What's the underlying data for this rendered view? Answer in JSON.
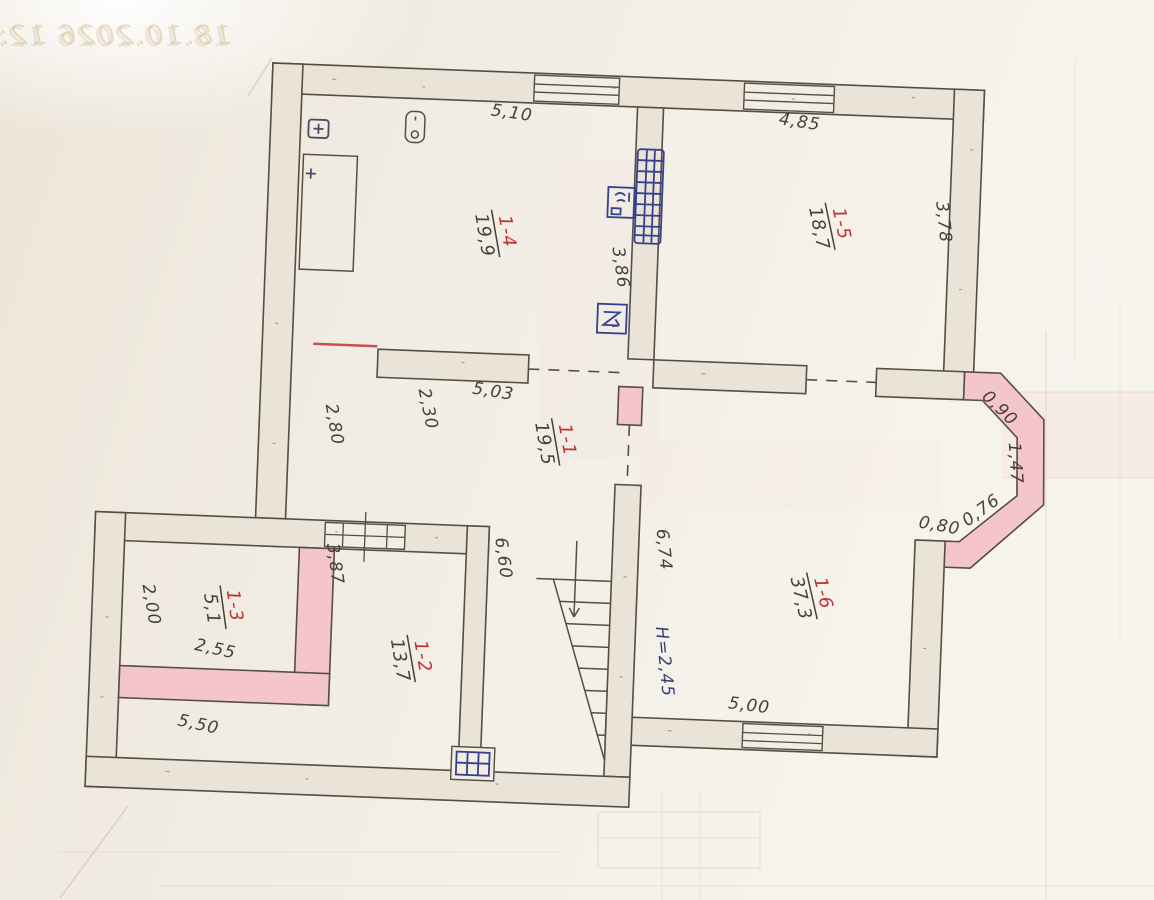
{
  "watermark": {
    "text": "18.10.2026 12:4"
  },
  "rooms": [
    {
      "num": "1-1",
      "area": "19,5"
    },
    {
      "num": "1-2",
      "area": "13,7"
    },
    {
      "num": "1-3",
      "area": "5,1"
    },
    {
      "num": "1-4",
      "area": "19,9"
    },
    {
      "num": "1-5",
      "area": "18,7"
    },
    {
      "num": "1-6",
      "area": "37,3"
    }
  ],
  "dimensions": {
    "r14_width": "5,10",
    "r15_width": "4,85",
    "mid_wall": "3,86",
    "r15_depth": "3,78",
    "hall_wall": "5,03",
    "hall_width": "2,30",
    "hall_left": "2,80",
    "bay_seg1": "0,90",
    "bay_seg2": "1,47",
    "bay_seg3": "0,76",
    "bay_seg4": "0,80",
    "stair_wall": "6,74",
    "stair_height": "H=2,45",
    "r16_window": "5,00",
    "r12_depth": "6,60",
    "r12_wall": "3,87",
    "r13_depth": "2,00",
    "r13_width": "2,55",
    "r12_width": "5,50"
  },
  "icons": {
    "ventilation_shaft": "hatched-grid",
    "sink": "basin-square",
    "stove": "zigzag-square",
    "boiler": "rounded-tank",
    "heater": "plus-square",
    "closet": "tall-rectangle",
    "flue": "small-grid-box",
    "stair_direction": "down-arrow"
  },
  "colors": {
    "paper": "#F3EFE7",
    "wall_fill": "#EAE3D8",
    "wall_line": "#564D43",
    "pink_highlight": "#F4C6CB",
    "fixture_blue": "#35418F",
    "pencil": "#46403A",
    "room_red": "#C03030",
    "height_ink": "#3C3E72"
  }
}
